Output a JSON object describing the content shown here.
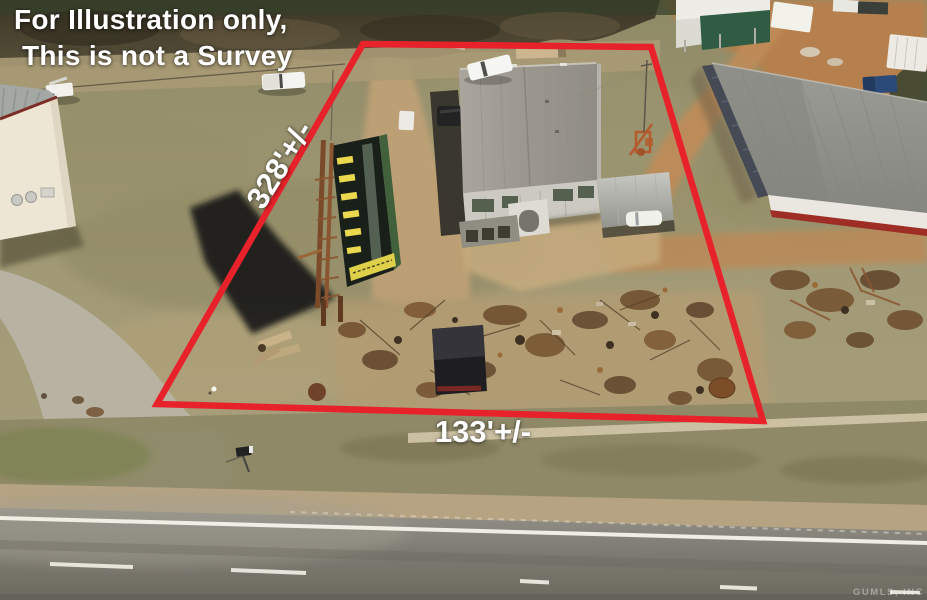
{
  "annotations": {
    "disclaimer_line1": "For Illustration only,",
    "disclaimer_line2": "This is not a Survey",
    "side_measurement": "328'+/-",
    "front_measurement": "133'+/-",
    "watermark": "GUMLS, INC"
  },
  "colors": {
    "property_outline": "#e8222b",
    "annotation_text": "#ffffff"
  },
  "scene": {
    "type": "aerial-drone-photo",
    "features": [
      "tree-line",
      "left-warehouse",
      "billboard",
      "central-warehouse",
      "carport",
      "right-warehouse",
      "scrap-yard",
      "black-shed",
      "dirt-driveway",
      "access-road",
      "highway",
      "mailbox",
      "white-pickup-trucks",
      "red-property-outline"
    ]
  }
}
